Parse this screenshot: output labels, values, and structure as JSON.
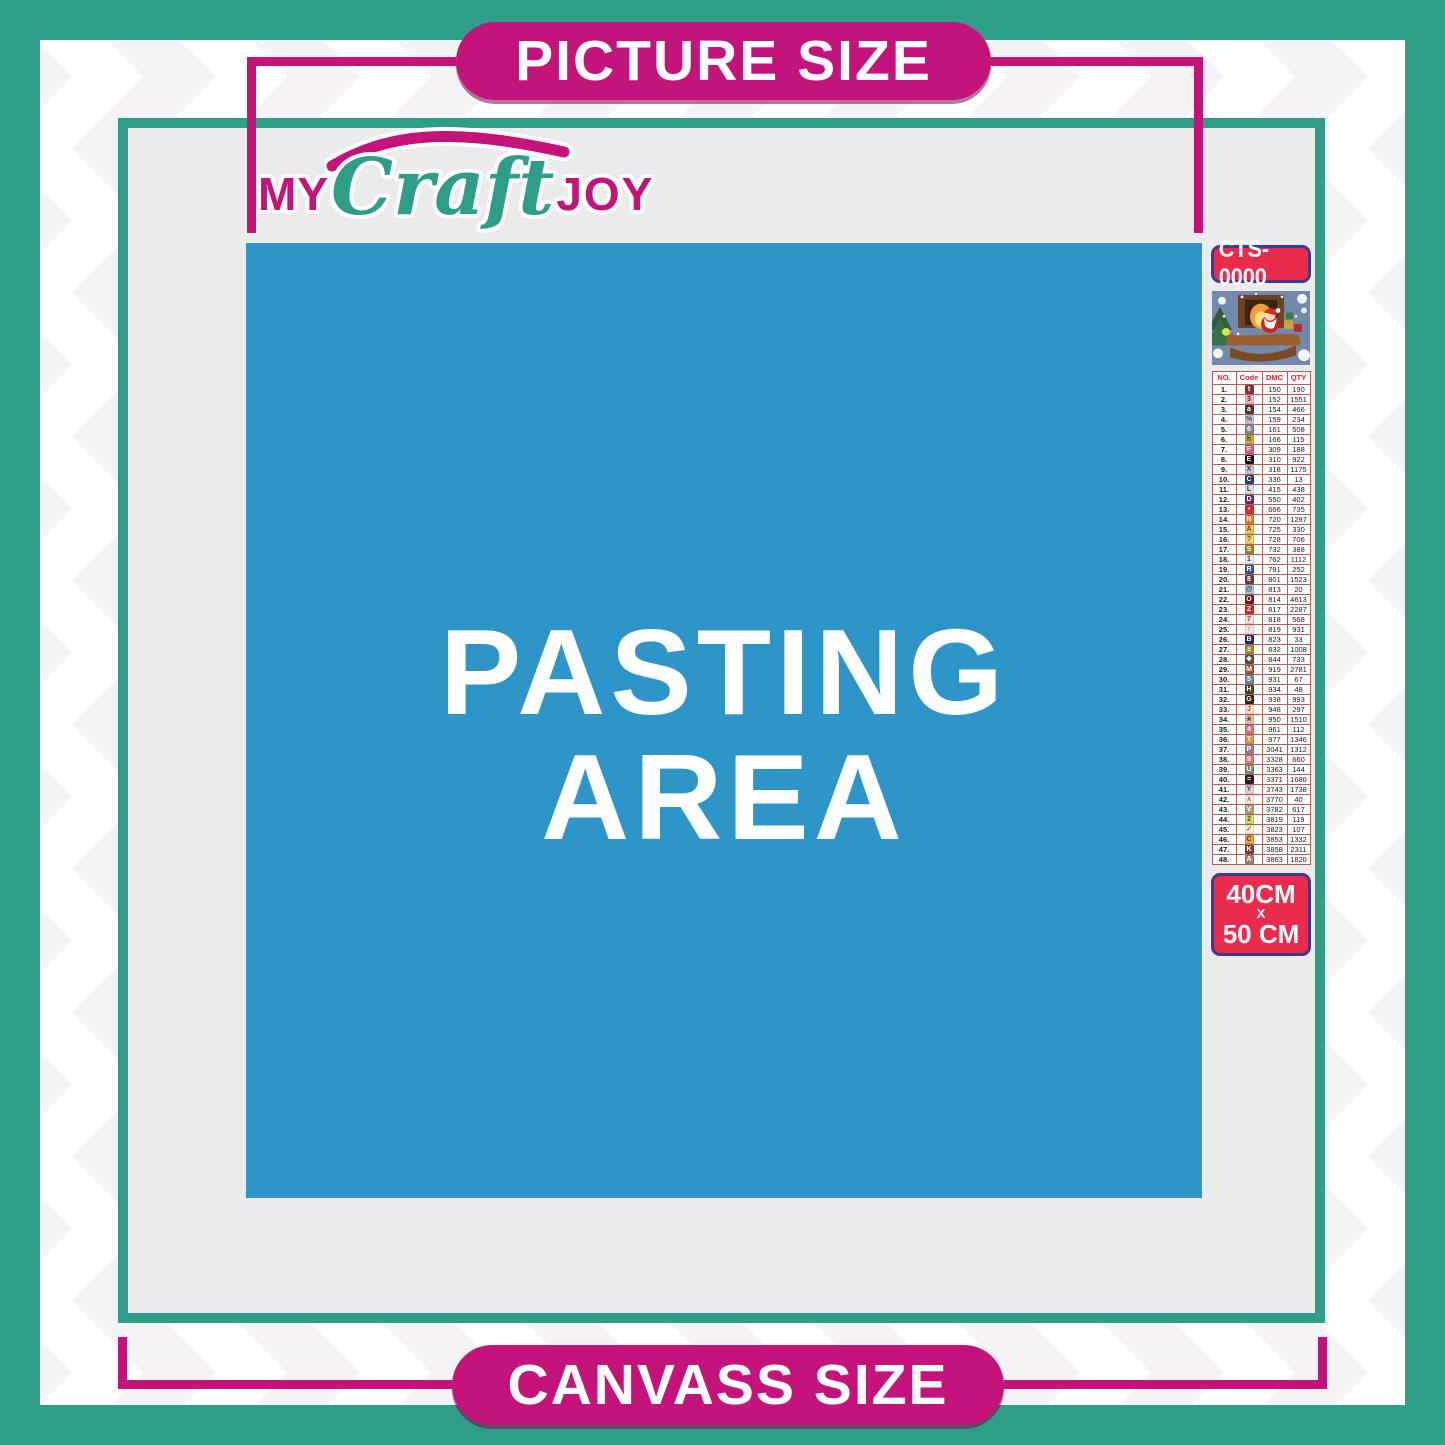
{
  "banners": {
    "top": "PICTURE SIZE",
    "bottom": "CANVASS SIZE"
  },
  "logo": {
    "my": "MY",
    "craft": "Craft",
    "joy": "JOY"
  },
  "pasting_area": {
    "line1": "PASTING",
    "line2": "AREA"
  },
  "sidebar": {
    "kit_code": "CTS-0000",
    "size_label": {
      "line1": "40CM",
      "line2": "X",
      "line3": "50 CM"
    },
    "table": {
      "headers": [
        "NO.",
        "Code",
        "DMC",
        "QTY"
      ],
      "rows": [
        {
          "no": "1.",
          "symbol": "t",
          "symbol_bg": "#8C2F38",
          "symbol_fg": "#ffffff",
          "dmc": "150",
          "qty": "190"
        },
        {
          "no": "2.",
          "symbol": "3",
          "symbol_bg": "#E9B9C0",
          "symbol_fg": "#5a2a32",
          "dmc": "152",
          "qty": "1551"
        },
        {
          "no": "3.",
          "symbol": "a",
          "symbol_bg": "#413A3E",
          "symbol_fg": "#ffffff",
          "dmc": "154",
          "qty": "466"
        },
        {
          "no": "4.",
          "symbol": "%",
          "symbol_bg": "#C9C6D2",
          "symbol_fg": "#4a4a5a",
          "dmc": "159",
          "qty": "234"
        },
        {
          "no": "5.",
          "symbol": "6",
          "symbol_bg": "#7E8A99",
          "symbol_fg": "#ffffff",
          "dmc": "161",
          "qty": "508"
        },
        {
          "no": "6.",
          "symbol": "h",
          "symbol_bg": "#BCB53B",
          "symbol_fg": "#3e3a10",
          "dmc": "166",
          "qty": "115"
        },
        {
          "no": "7.",
          "symbol": "F",
          "symbol_bg": "#DE5D6E",
          "symbol_fg": "#ffffff",
          "dmc": "309",
          "qty": "188"
        },
        {
          "no": "8.",
          "symbol": "E",
          "symbol_bg": "#151515",
          "symbol_fg": "#ffffff",
          "dmc": "310",
          "qty": "922"
        },
        {
          "no": "9.",
          "symbol": "X",
          "symbol_bg": "#CBCBD1",
          "symbol_fg": "#3a3a3a",
          "dmc": "318",
          "qty": "1175"
        },
        {
          "no": "10.",
          "symbol": "C",
          "symbol_bg": "#27406B",
          "symbol_fg": "#ffffff",
          "dmc": "336",
          "qty": "13"
        },
        {
          "no": "11.",
          "symbol": "L",
          "symbol_bg": "#DCDCE2",
          "symbol_fg": "#3a3a3a",
          "dmc": "415",
          "qty": "438"
        },
        {
          "no": "12.",
          "symbol": "D",
          "symbol_bg": "#5E3070",
          "symbol_fg": "#ffffff",
          "dmc": "550",
          "qty": "402"
        },
        {
          "no": "13.",
          "symbol": "•",
          "symbol_bg": "#E32734",
          "symbol_fg": "#ffffff",
          "dmc": "666",
          "qty": "735"
        },
        {
          "no": "14.",
          "symbol": "N",
          "symbol_bg": "#E8763B",
          "symbol_fg": "#ffffff",
          "dmc": "720",
          "qty": "1297"
        },
        {
          "no": "15.",
          "symbol": "A",
          "symbol_bg": "#F2C94C",
          "symbol_fg": "#6a4a00",
          "dmc": "725",
          "qty": "330"
        },
        {
          "no": "16.",
          "symbol": "?",
          "symbol_bg": "#EFD36E",
          "symbol_fg": "#6a5510",
          "dmc": "728",
          "qty": "706"
        },
        {
          "no": "17.",
          "symbol": "S",
          "symbol_bg": "#95891F",
          "symbol_fg": "#ffffff",
          "dmc": "732",
          "qty": "388"
        },
        {
          "no": "18.",
          "symbol": "1",
          "symbol_bg": "#ECECF0",
          "symbol_fg": "#3a3a3a",
          "dmc": "762",
          "qty": "1112"
        },
        {
          "no": "19.",
          "symbol": "R",
          "symbol_bg": "#41529E",
          "symbol_fg": "#ffffff",
          "dmc": "791",
          "qty": "252"
        },
        {
          "no": "20.",
          "symbol": "8",
          "symbol_bg": "#6E4130",
          "symbol_fg": "#ffffff",
          "dmc": "801",
          "qty": "1523"
        },
        {
          "no": "21.",
          "symbol": "@",
          "symbol_bg": "#A9CBE0",
          "symbol_fg": "#2a4a6a",
          "dmc": "813",
          "qty": "20"
        },
        {
          "no": "22.",
          "symbol": "O",
          "symbol_bg": "#6E1824",
          "symbol_fg": "#ffffff",
          "dmc": "814",
          "qty": "4613"
        },
        {
          "no": "23.",
          "symbol": "Z",
          "symbol_bg": "#D12B20",
          "symbol_fg": "#ffffff",
          "dmc": "817",
          "qty": "2287"
        },
        {
          "no": "24.",
          "symbol": "7",
          "symbol_bg": "#F7DEE2",
          "symbol_fg": "#7a4a52",
          "dmc": "818",
          "qty": "568"
        },
        {
          "no": "25.",
          "symbol": "↑",
          "symbol_bg": "#F6E4E1",
          "symbol_fg": "#7a5a52",
          "dmc": "819",
          "qty": "931"
        },
        {
          "no": "26.",
          "symbol": "B",
          "symbol_bg": "#20305A",
          "symbol_fg": "#ffffff",
          "dmc": "823",
          "qty": "33"
        },
        {
          "no": "27.",
          "symbol": "±",
          "symbol_bg": "#AA8A2E",
          "symbol_fg": "#ffffff",
          "dmc": "832",
          "qty": "1008"
        },
        {
          "no": "28.",
          "symbol": "❖",
          "symbol_bg": "#50504F",
          "symbol_fg": "#ffffff",
          "dmc": "844",
          "qty": "733"
        },
        {
          "no": "29.",
          "symbol": "M",
          "symbol_bg": "#A84E28",
          "symbol_fg": "#ffffff",
          "dmc": "919",
          "qty": "2781"
        },
        {
          "no": "30.",
          "symbol": "5",
          "symbol_bg": "#70879F",
          "symbol_fg": "#ffffff",
          "dmc": "931",
          "qty": "67"
        },
        {
          "no": "31.",
          "symbol": "H",
          "symbol_bg": "#42472B",
          "symbol_fg": "#ffffff",
          "dmc": "934",
          "qty": "48"
        },
        {
          "no": "32.",
          "symbol": "G",
          "symbol_bg": "#39231A",
          "symbol_fg": "#ffffff",
          "dmc": "938",
          "qty": "993"
        },
        {
          "no": "33.",
          "symbol": "J",
          "symbol_bg": "#F7DECB",
          "symbol_fg": "#8a5a3a",
          "dmc": "948",
          "qty": "297"
        },
        {
          "no": "34.",
          "symbol": "★",
          "symbol_bg": "#E9C3A8",
          "symbol_fg": "#6a4a2a",
          "dmc": "950",
          "qty": "1510"
        },
        {
          "no": "35.",
          "symbol": "4",
          "symbol_bg": "#D4728A",
          "symbol_fg": "#ffffff",
          "dmc": "961",
          "qty": "112"
        },
        {
          "no": "36.",
          "symbol": "T",
          "symbol_bg": "#DD9440",
          "symbol_fg": "#ffffff",
          "dmc": "977",
          "qty": "1346"
        },
        {
          "no": "37.",
          "symbol": "P",
          "symbol_bg": "#94809A",
          "symbol_fg": "#ffffff",
          "dmc": "3041",
          "qty": "1312"
        },
        {
          "no": "38.",
          "symbol": "9",
          "symbol_bg": "#DC7A80",
          "symbol_fg": "#ffffff",
          "dmc": "3328",
          "qty": "660"
        },
        {
          "no": "39.",
          "symbol": "U",
          "symbol_bg": "#74906F",
          "symbol_fg": "#ffffff",
          "dmc": "3363",
          "qty": "144"
        },
        {
          "no": "40.",
          "symbol": "=",
          "symbol_bg": "#2A1B10",
          "symbol_fg": "#ffffff",
          "dmc": "3371",
          "qty": "1680"
        },
        {
          "no": "41.",
          "symbol": "Y",
          "symbol_bg": "#D9D2DF",
          "symbol_fg": "#4a4a5a",
          "dmc": "3743",
          "qty": "1738"
        },
        {
          "no": "42.",
          "symbol": "∧",
          "symbol_bg": "#F9EEE0",
          "symbol_fg": "#8a7a5a",
          "dmc": "3770",
          "qty": "40"
        },
        {
          "no": "43.",
          "symbol": "V",
          "symbol_bg": "#AD9A87",
          "symbol_fg": "#ffffff",
          "dmc": "3782",
          "qty": "617"
        },
        {
          "no": "44.",
          "symbol": "2",
          "symbol_bg": "#D8DB6F",
          "symbol_fg": "#4a5510",
          "dmc": "3819",
          "qty": "119"
        },
        {
          "no": "45.",
          "symbol": "✓",
          "symbol_bg": "#FAF2D2",
          "symbol_fg": "#6a6a20",
          "dmc": "3823",
          "qty": "107"
        },
        {
          "no": "46.",
          "symbol": "C",
          "symbol_bg": "#ECA04A",
          "symbol_fg": "#6a3a00",
          "dmc": "3853",
          "qty": "1332"
        },
        {
          "no": "47.",
          "symbol": "K",
          "symbol_bg": "#82403B",
          "symbol_fg": "#ffffff",
          "dmc": "3858",
          "qty": "2311"
        },
        {
          "no": "48.",
          "symbol": "A",
          "symbol_bg": "#9C8070",
          "symbol_fg": "#ffffff",
          "dmc": "3863",
          "qty": "1820"
        }
      ]
    }
  },
  "colors": {
    "teal": "#2f9e88",
    "magenta": "#c4137a",
    "red": "#ea2b4e",
    "navy": "#3c3c8c",
    "blue": "#2d95c8",
    "canvas_gray": "#ebebeb",
    "table_red": "#e8202c"
  }
}
